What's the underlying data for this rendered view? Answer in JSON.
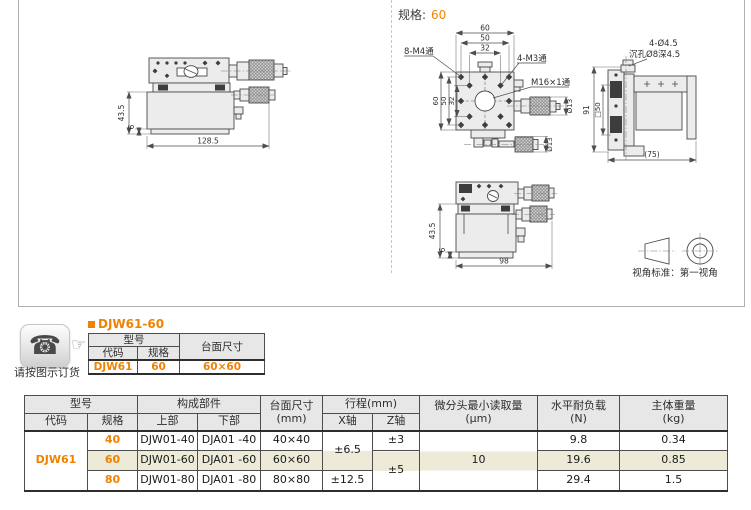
{
  "colors": {
    "accent_orange": "#ef8200",
    "row_highlight": "#edead8",
    "table_header_bg": "#e7e7e7",
    "border_dark": "#4d4d4d"
  },
  "drawing_panel": {
    "spec_prefix": "规格:",
    "spec_value": "60",
    "view_side": {
      "dim_height": "43.5",
      "dim_base": "6",
      "dim_width": "128.5"
    },
    "view_front": {
      "dim_top_60": "60",
      "dim_top_50": "50",
      "dim_top_32": "32",
      "dim_left_60": "60",
      "dim_left_50": "50",
      "dim_left_32": "32",
      "label_m4": "8-M4通",
      "label_m3": "4-M3通",
      "label_m16": "M16×1通",
      "label_dia13": "Ø13"
    },
    "view_right": {
      "dim_height": "91",
      "dim_square": "□50",
      "dim_depth": "(75)",
      "label_holes": "4-Ø4.5",
      "label_cbore": "沉孔Ø8深4.5"
    },
    "view_front_lower": {
      "dim_height": "43.5",
      "dim_base": "6",
      "dim_width": "98"
    },
    "projection_note": "视角标准：第一视角"
  },
  "order_section": {
    "phone_note": "请按图示订货",
    "product_title": "DJW61-60",
    "icons": {
      "phone_glyph": "☎",
      "pointing_hand_glyph": "☞"
    },
    "table": {
      "h_model": "型号",
      "h_code": "代码",
      "h_spec": "规格",
      "h_size": "台面尺寸",
      "row": {
        "code": "DJW61",
        "spec": "60",
        "size": "60×60"
      }
    }
  },
  "spec_table": {
    "h_model": "型号",
    "h_code": "代码",
    "h_spec": "规格",
    "h_components": "构成部件",
    "h_upper": "上部",
    "h_lower": "下部",
    "h_size_1": "台面尺寸",
    "h_size_2": "(mm)",
    "h_travel": "行程(mm)",
    "h_x": "X轴",
    "h_z": "Z轴",
    "h_res_1": "微分头最小读取量",
    "h_res_2": "(μm)",
    "h_load_1": "水平耐负载",
    "h_load_2": "(N)",
    "h_weight_1": "主体重量",
    "h_weight_2": "(kg)",
    "code": "DJW61",
    "resolution": "10",
    "travel": {
      "x40_60": "±6.5",
      "x80": "±12.5",
      "z40": "±3",
      "z60_80": "±5"
    },
    "rows": [
      {
        "spec": "40",
        "upper": "DJW01-40",
        "lower": "DJA01 -40",
        "size": "40×40",
        "load": "9.8",
        "weight": "0.34"
      },
      {
        "spec": "60",
        "upper": "DJW01-60",
        "lower": "DJA01 -60",
        "size": "60×60",
        "load": "19.6",
        "weight": "0.85"
      },
      {
        "spec": "80",
        "upper": "DJW01-80",
        "lower": "DJA01 -80",
        "size": "80×80",
        "load": "29.4",
        "weight": "1.5"
      }
    ]
  }
}
